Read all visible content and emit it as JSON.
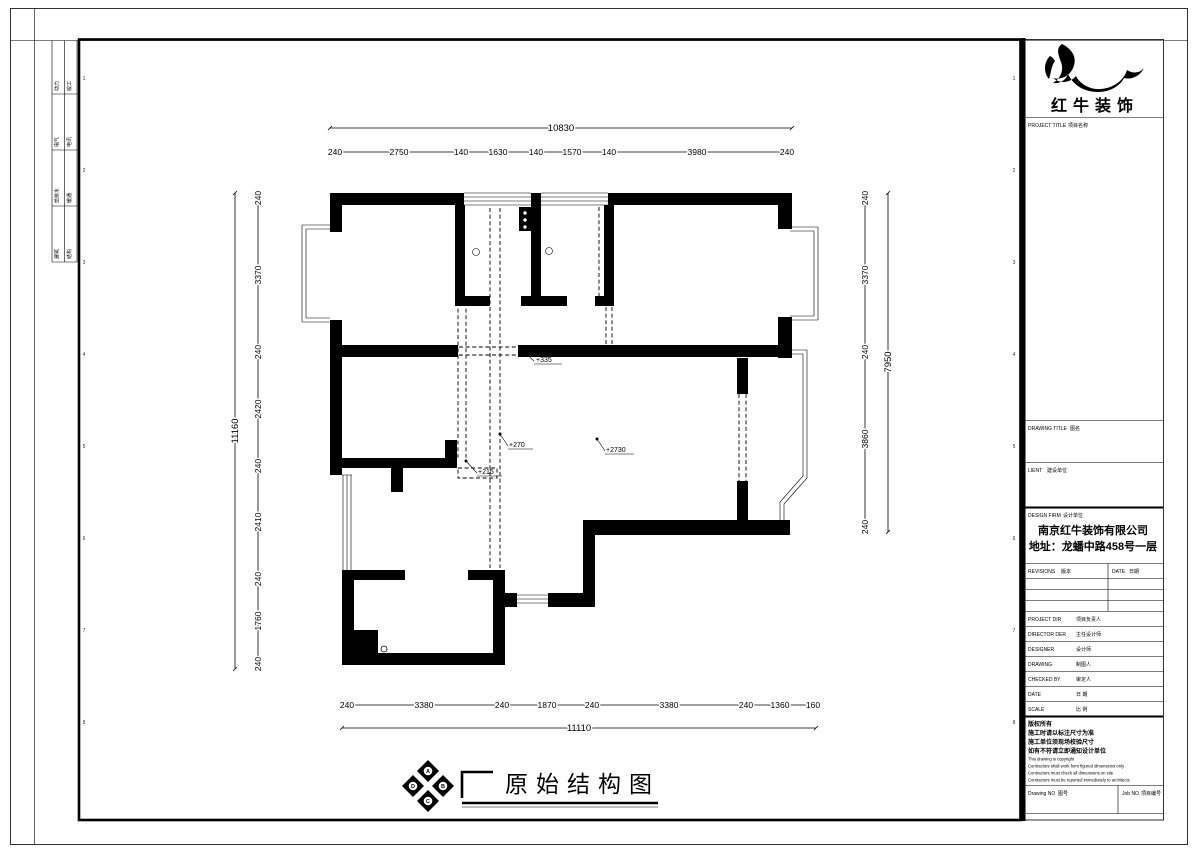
{
  "colors": {
    "ink": "#000000",
    "paper": "#ffffff"
  },
  "brand": {
    "name": "红牛装饰"
  },
  "titleblock": {
    "project_title": {
      "en": "PROJECT TITLE",
      "cn": "项目名称"
    },
    "drawing_title": {
      "en": "DRAWING TITLE",
      "cn": "图名"
    },
    "client": {
      "en": "LIENT",
      "cn": "建设单位"
    },
    "design_firm": {
      "en": "DESIGN FIRM",
      "cn": "设计单位"
    },
    "firm_name": "南京红牛装饰有限公司",
    "firm_addr": "地址：龙蟠中路458号一层",
    "revisions": {
      "en": "REVISIONS",
      "cn": "版本"
    },
    "date_col": {
      "en": "DATE",
      "cn": "日期"
    },
    "rows": [
      {
        "en": "PROJECT DIR",
        "cn": "项目负责人"
      },
      {
        "en": "DIRECTOR DER",
        "cn": "主任设计师"
      },
      {
        "en": "DESIGNER",
        "cn": "设计师"
      },
      {
        "en": "DRAWING",
        "cn": "制图人"
      },
      {
        "en": "CHECKED BY",
        "cn": "审定人"
      },
      {
        "en": "DATE",
        "cn": "日  期"
      },
      {
        "en": "SCALE",
        "cn": "比  例"
      }
    ],
    "copyright_cn": [
      "版权所有",
      "施工时请以标注尺寸为准",
      "施工单位须现场校验尺寸",
      "如有不符请立即通知设计单位"
    ],
    "copyright_en": [
      "This drawing is copyright",
      "Contractors shall work form figured dimensions only",
      "Contractors must check all dimensions on site",
      "Contractors must be reported immediately to architects"
    ],
    "drawing_no": {
      "en": "Drawing NO",
      "cn": "图号"
    },
    "job_no": {
      "en": "Job NO",
      "cn": "项目编号"
    }
  },
  "stamps": {
    "rows": [
      {
        "l": "动力",
        "r": "竣工"
      },
      {
        "l": "电气",
        "r": "电讯"
      },
      {
        "l": "给排水",
        "r": "暖通"
      },
      {
        "l": "建筑",
        "r": "结构"
      }
    ]
  },
  "zones": [
    "1",
    "2",
    "3",
    "4",
    "5",
    "6",
    "7",
    "8"
  ],
  "plan": {
    "levels": [
      "+335",
      "+270",
      "+215",
      "+2730"
    ],
    "dims": {
      "top_total": "10830",
      "top": [
        "240",
        "2750",
        "140",
        "1630",
        "140",
        "1570",
        "140",
        "3980",
        "240"
      ],
      "bottom_total": "11110",
      "bottom": [
        "240",
        "3380",
        "240",
        "1870",
        "240",
        "3380",
        "240",
        "1360",
        "160"
      ],
      "left_total": "11160",
      "left": [
        "240",
        "3370",
        "240",
        "2420",
        "240",
        "2410",
        "240",
        "1760",
        "240"
      ],
      "right_total": "7950",
      "right": [
        "240",
        "3370",
        "240",
        "3860",
        "240"
      ]
    }
  },
  "footer": {
    "title": "原始结构图",
    "compass": [
      "A",
      "B",
      "C",
      "D"
    ]
  }
}
